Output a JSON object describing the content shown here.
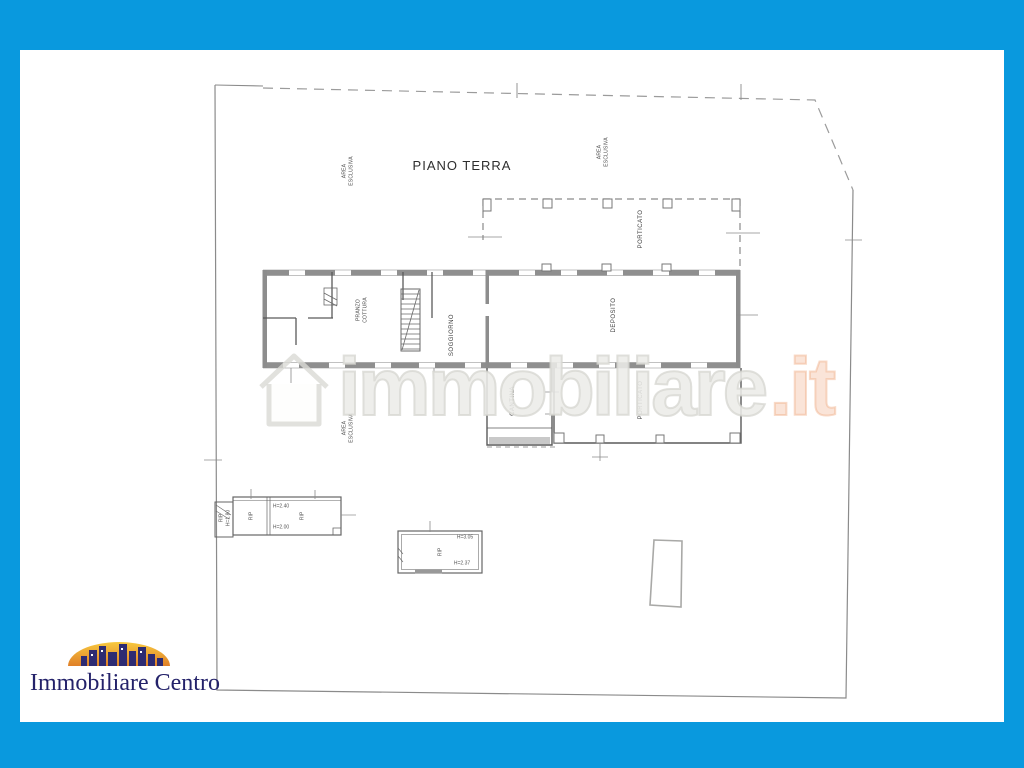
{
  "frame": {
    "color": "#0999de"
  },
  "floor_plan": {
    "title": "PIANO TERRA",
    "area_label": {
      "line1": "AREA",
      "line2": "ESCLUSIVA"
    },
    "rooms": {
      "porticato": "PORTICATO",
      "pranzo_line1": "PRANZO",
      "pranzo_line2": "COTTURA",
      "soggiorno": "SOGGIORNO",
      "deposito": "DEPOSITO",
      "cantina": "CANTINA"
    },
    "annotations": {
      "rip": "RIP",
      "shed_height": "H=1.80",
      "h_240": "H=2.40",
      "h_200": "H=2.00",
      "h_305": "H=3.05",
      "h_237": "H=2.37"
    }
  },
  "watermark": {
    "name": "immobiliare",
    "tld": ".it",
    "gray": "#e9e9e5",
    "orange": "#eea67a"
  },
  "logo": {
    "name": "Immobiliare Centro",
    "navy": "#24226a",
    "sun_top": "#f7c93f",
    "sun_bottom": "#e07f28"
  }
}
